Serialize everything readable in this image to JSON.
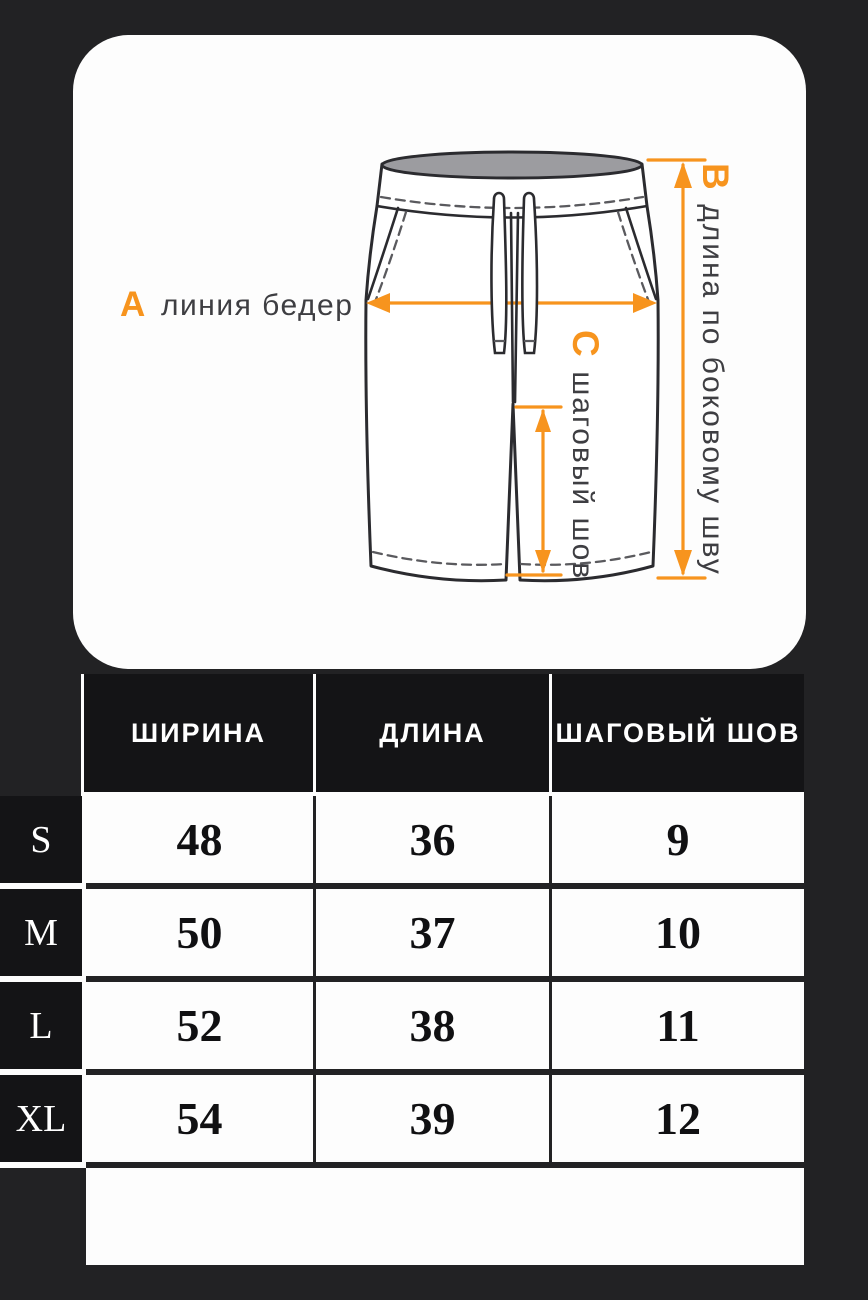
{
  "colors": {
    "accent": "#f7941e",
    "background": "#222224",
    "card": "#fdfdfd"
  },
  "diagram": {
    "label_a": {
      "letter": "А",
      "text": "линия бедер"
    },
    "label_b": {
      "letter": "В",
      "text": "длина по боковому шву"
    },
    "label_c": {
      "letter": "С",
      "text": "шаговый шов"
    }
  },
  "table": {
    "columns": [
      "ШИРИНА",
      "ДЛИНА",
      "ШАГОВЫЙ ШОВ"
    ],
    "rows": [
      {
        "size": "S",
        "values": [
          "48",
          "36",
          "9"
        ]
      },
      {
        "size": "M",
        "values": [
          "50",
          "37",
          "10"
        ]
      },
      {
        "size": "L",
        "values": [
          "52",
          "38",
          "11"
        ]
      },
      {
        "size": "XL",
        "values": [
          "54",
          "39",
          "12"
        ]
      }
    ]
  }
}
